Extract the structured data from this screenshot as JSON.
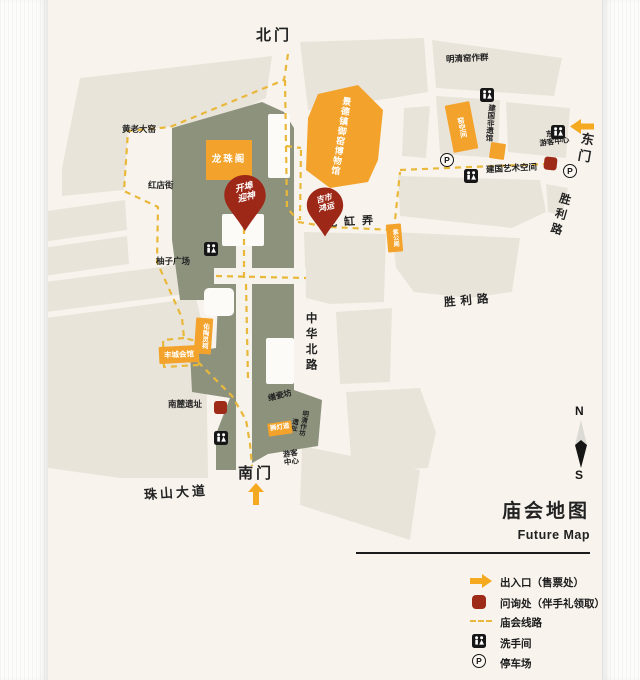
{
  "title": {
    "zh": "庙会地图",
    "en": "Future Map"
  },
  "compass": {
    "north": "N",
    "south": "S"
  },
  "gates": {
    "north": "北门",
    "south": "南门",
    "east": "东门"
  },
  "streets": {
    "zhushan_avenue": "珠山大道",
    "zhonghua_north_rd": "中华北路",
    "shengli_rd_mid": "胜利路",
    "shengli_rd_ne": "胜利路",
    "longgang_lane": "龙 缸 弄",
    "hongdian_street": "红店街"
  },
  "places": {
    "longzhu_pavilion": "龙珠阁",
    "imperial_kiln_museum": "景德镇御窑博物馆",
    "mingqing_kiln_group": "明清窑作群",
    "huanglao_kiln": "黄老大窑",
    "youzi_square": "柚子广场",
    "yao_space": "窑空间",
    "jianguo_heritage_hall": "建国非遗馆",
    "jianguo_art_space": "建国艺术空间",
    "east_visitor_center_l1": "东门",
    "east_visitor_center_l2": "游客中心",
    "zigong_pavilion": "紫公阁",
    "youtao_shrine": "佑陶灵祠",
    "fengcheng_hall": "丰城会馆",
    "nanlu_ruins": "南麓遗址",
    "shanci_workshop": "缮瓷坊",
    "shideng_road": "狮灯道",
    "mingqing_workshop": "明清作坊",
    "ruins": "遗址",
    "south_visitor_center_l1": "游客",
    "south_visitor_center_l2": "中心"
  },
  "markers": {
    "kaibu_yingshen": {
      "line1": "开埠",
      "line2": "迎神"
    },
    "jishi_hongyun": {
      "line1": "吉市",
      "line2": "鸿运"
    }
  },
  "legend": {
    "items": [
      {
        "type": "entrance-arrow",
        "label": "出入口（售票处）"
      },
      {
        "type": "inquiry-square",
        "label": "问询处（伴手礼领取）"
      },
      {
        "type": "route-dashes",
        "label": "庙会线路"
      },
      {
        "type": "restroom",
        "label": "洗手间"
      },
      {
        "type": "parking",
        "label": "停车场"
      }
    ]
  },
  "colors": {
    "accent_orange": "#f3a32b",
    "marker_red": "#9e2a18",
    "route_yellow": "#e9b83a",
    "park_green": "#8d927d",
    "block_beige": "#e9e4da",
    "background_cream": "#f8f4ed"
  }
}
